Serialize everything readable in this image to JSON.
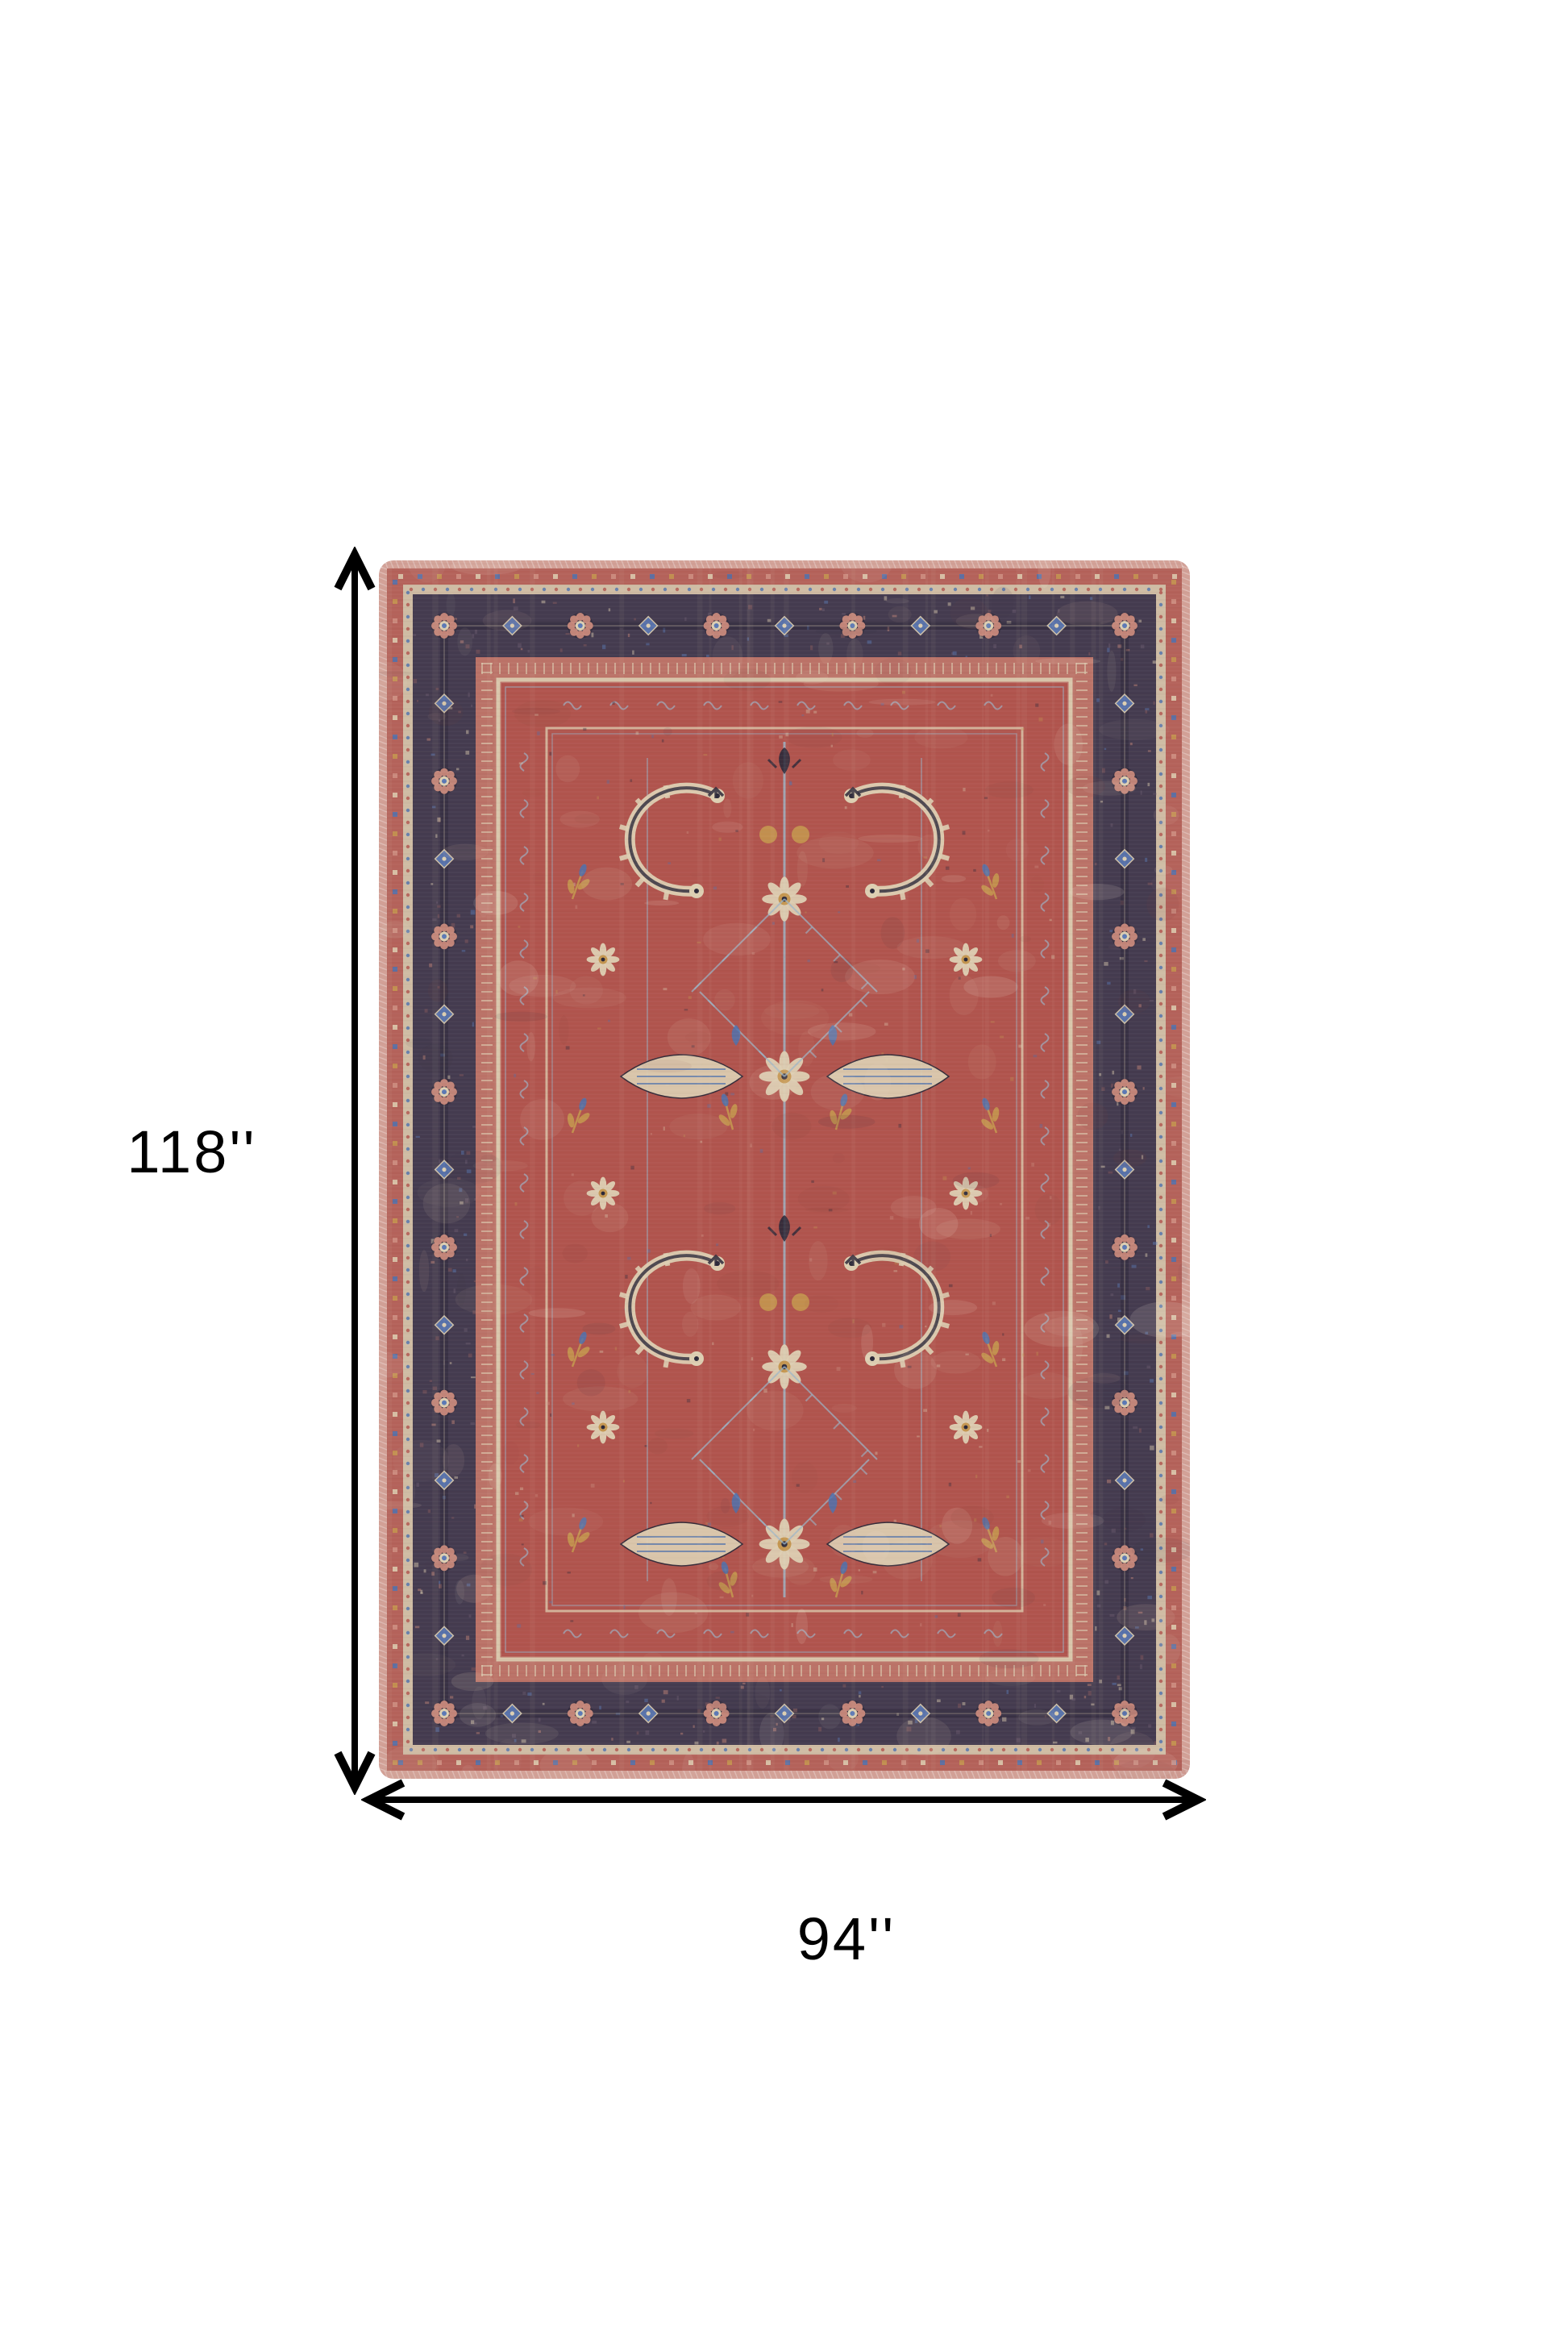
{
  "page": {
    "background_color": "#ffffff",
    "description": "Product dimension diagram of a vintage persian style area rug shown top-down with measurement arrows"
  },
  "dimensions": {
    "height_label": "118''",
    "width_label": "94''",
    "arrow_color": "#000000",
    "label_color": "#000000"
  },
  "rug": {
    "style": "vintage persian heriz area rug",
    "colors": {
      "selvage": "#d2a096",
      "outer_band": "#b4625a",
      "cream_guard": "#cfbca4",
      "border_navy": "#443b4f",
      "border_motif_pink": "#c9897b",
      "border_motif_blue": "#5b79b5",
      "guard_band": "#bb7267",
      "field_red": "#b0544d",
      "pattern_cream": "#ddcfb2",
      "pattern_light_blue": "#9cb6c9",
      "pattern_blue": "#4f72ae",
      "pattern_gold": "#c4964f",
      "pattern_dark": "#2b2838",
      "pattern_pink": "#cf9183"
    }
  }
}
